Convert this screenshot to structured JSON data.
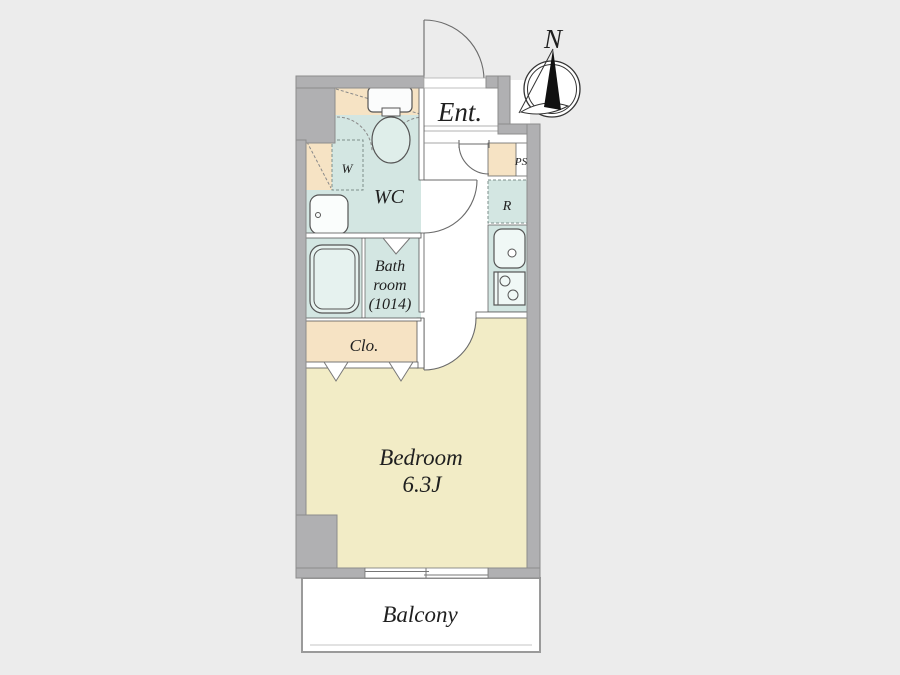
{
  "plan": {
    "compass": {
      "label": "N"
    },
    "rooms": {
      "entrance": {
        "label": "Ent."
      },
      "washroom": {
        "label": "WC"
      },
      "washer_space": {
        "label": "W"
      },
      "pipe_space": {
        "label": "PS"
      },
      "refrigerator_space": {
        "label": "R"
      },
      "bathroom": {
        "line1": "Bath",
        "line2": "room",
        "line3": "(1014)"
      },
      "closet": {
        "label": "Clo."
      },
      "bedroom": {
        "label": "Bedroom",
        "size": "6.3J"
      },
      "balcony": {
        "label": "Balcony"
      }
    },
    "colors": {
      "background": "#ececec",
      "wall": "#b0b0b2",
      "wet_area_floor": "#d3e6e2",
      "storage_floor": "#f6e3c4",
      "bedroom_floor": "#f2ecc6",
      "outline": "#555555"
    }
  }
}
